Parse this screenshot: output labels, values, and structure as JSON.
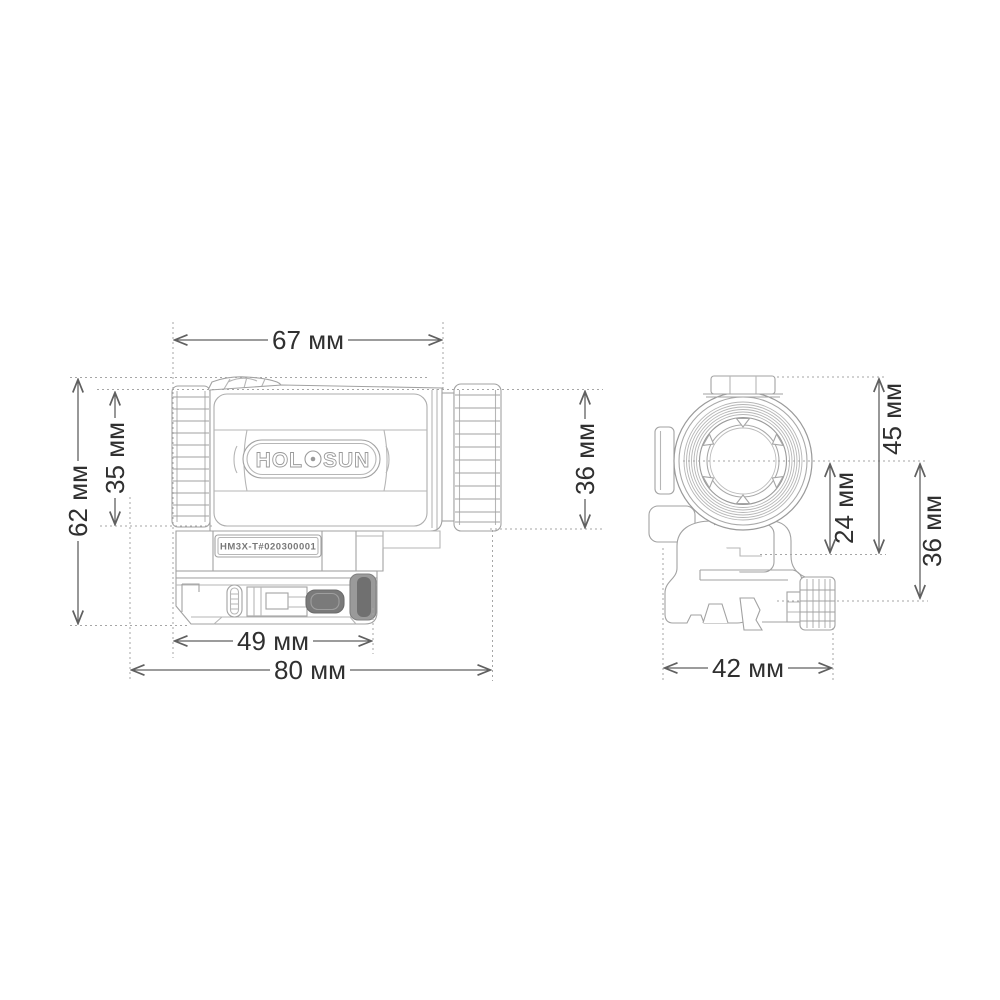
{
  "document": {
    "type": "technical dimension drawing",
    "subject": "Holosun HM3X-T 3x magnifier, side view and front view with dimensions",
    "background": "#ffffff",
    "units": "мм"
  },
  "branding": {
    "logo_prefix": "HOL",
    "logo_suffix": "SUN",
    "serial": "HM3X-T#020300001"
  },
  "dimensions": {
    "side_view": {
      "body_length_top": "67 мм",
      "overall_height": "62 мм",
      "tube_height": "35 мм",
      "eyepiece_ring_height": "36 мм",
      "mount_base_length": "49 мм",
      "overall_length": "80 мм"
    },
    "front_view": {
      "top_to_mount_shelf": "45 мм",
      "axis_to_mount_shelf": "24 мм",
      "axis_to_rail": "36 мм",
      "overall_width": "42 мм"
    }
  },
  "colors": {
    "outline": "#a2a2a2",
    "outline_fine": "#b6b6b6",
    "dimension_line": "#606060",
    "dimension_text": "#303030",
    "extension_dotted": "#a6a6a6",
    "dark_part": "#7a7a7a",
    "darker_part": "#707070"
  }
}
